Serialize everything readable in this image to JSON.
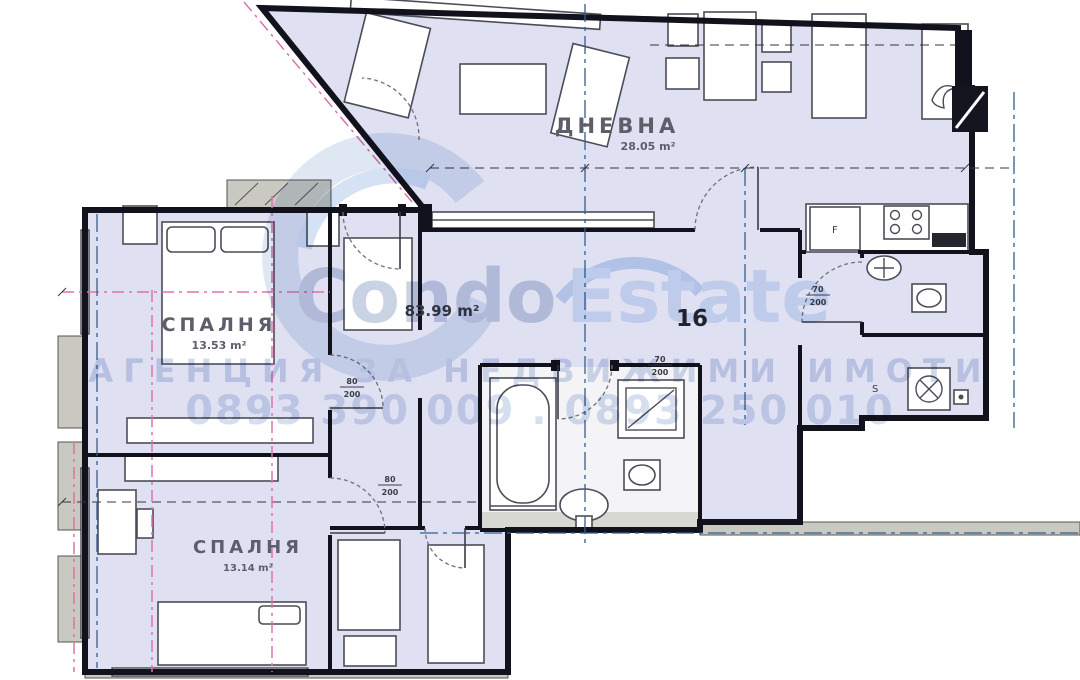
{
  "plan": {
    "unit_number": "16",
    "total_area": "83.99 m²",
    "rooms": [
      {
        "name": "ДНЕВНА",
        "area": "28.05 m²"
      },
      {
        "name": "СПАЛНЯ",
        "area": "13.53 m²"
      },
      {
        "name": "СПАЛНЯ",
        "area": "13.14 m²"
      }
    ],
    "doors": [
      {
        "w": "80",
        "h": "200"
      },
      {
        "w": "70",
        "h": "200"
      },
      {
        "w": "70",
        "h": "200"
      },
      {
        "w": "80",
        "h": "200"
      }
    ],
    "fixtures": {
      "fridge": "F",
      "siphon": "S"
    }
  },
  "watermark": {
    "brand_part1": "Condo",
    "brand_part2": "Estate",
    "tagline": "АГЕНЦИЯ ЗА НЕДВИЖИМИ ИМОТИ",
    "phone": "0893 390 009 . 0893 250 010"
  },
  "colors": {
    "room_fill": "#dfe1f3",
    "wall": "#12121c",
    "watermark_blue": "#b7c7e4",
    "revision_pink": "#e070b0",
    "axis_blue": "#2d5f94",
    "ledge_gray": "#c9c9c2"
  }
}
